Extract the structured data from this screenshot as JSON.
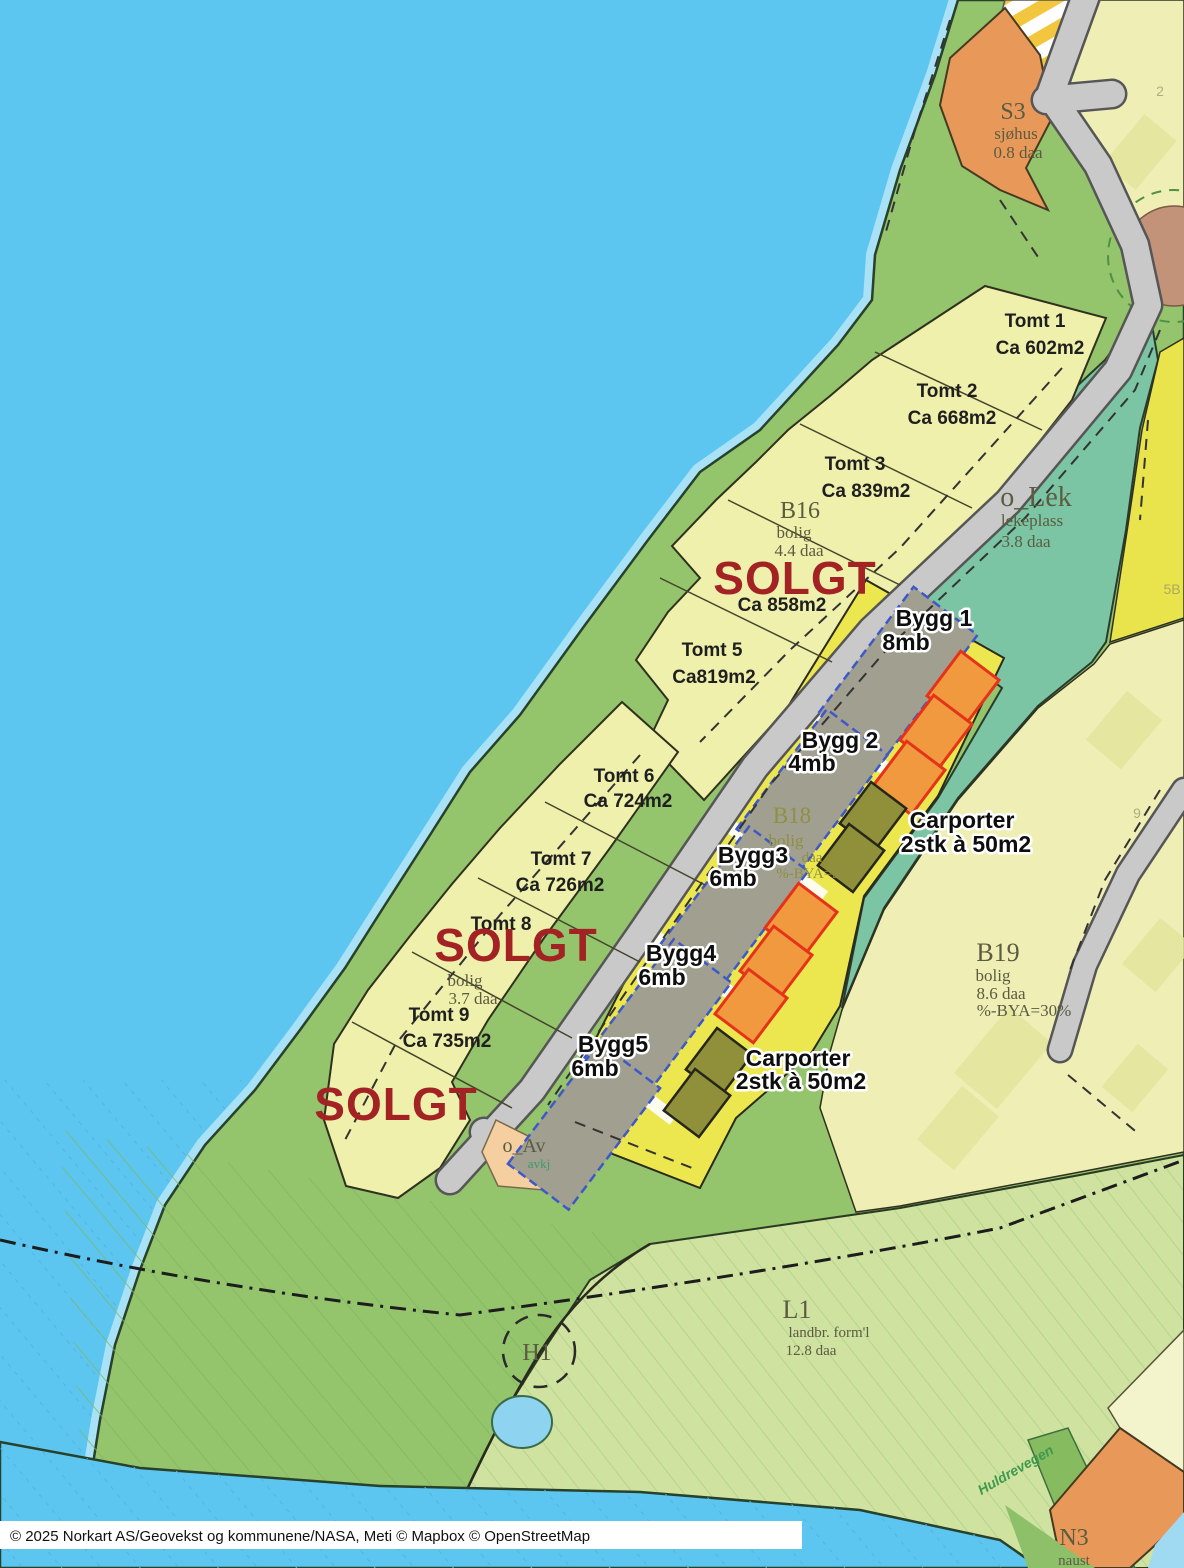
{
  "map": {
    "copyright": "© 2025 Norkart AS/Geovekst og kommunene/NASA, Meti © Mapbox © OpenStreetMap",
    "sold_label": "SOLGT",
    "street_name": "Huldrevegen",
    "areas": {
      "s3": {
        "code": "S3",
        "type": "sjøhus",
        "size": "0.8 daa"
      },
      "lek": {
        "code": "o_Lek",
        "type": "lekeplass",
        "size": "3.8 daa"
      },
      "b16": {
        "code": "B16",
        "type": "bolig",
        "size": "4.4 daa"
      },
      "b17": {
        "type": "bolig",
        "size": "3.7 daa"
      },
      "b18": {
        "code": "B18",
        "type": "bolig",
        "size": "daa",
        "bya": "%-BYA=30%"
      },
      "b19": {
        "code": "B19",
        "type": "bolig",
        "size": "8.6 daa",
        "bya": "%-BYA=30%"
      },
      "l1": {
        "code": "L1",
        "type": "landbr. form'l",
        "size": "12.8 daa"
      },
      "h1": {
        "code": "H1"
      },
      "n3": {
        "code": "N3",
        "type": "naust"
      },
      "av": {
        "code": "o_Av",
        "sub": "avkj"
      }
    },
    "plots": [
      {
        "name": "Tomt 1",
        "size": "Ca 602m2"
      },
      {
        "name": "Tomt 2",
        "size": "Ca 668m2"
      },
      {
        "name": "Tomt 3",
        "size": "Ca 839m2"
      },
      {
        "size": "Ca 858m2"
      },
      {
        "name": "Tomt 5",
        "size": "Ca819m2"
      },
      {
        "name": "Tomt 6",
        "size": "Ca 724m2"
      },
      {
        "name": "Tomt 7",
        "size": "Ca 726m2"
      },
      {
        "name": "Tomt 8"
      },
      {
        "name": "Tomt 9",
        "size": "Ca 735m2"
      }
    ],
    "buildings": [
      {
        "name": "Bygg 1",
        "height": "8mb"
      },
      {
        "name": "Bygg 2",
        "height": "4mb"
      },
      {
        "name": "Bygg3",
        "height": "6mb"
      },
      {
        "name": "Bygg4",
        "height": "6mb"
      },
      {
        "name": "Bygg5",
        "height": "6mb"
      }
    ],
    "carports": {
      "title": "Carporter",
      "detail": "2stk à 50m2"
    },
    "background_numbers": {
      "n2": "2",
      "n5b": "5B",
      "n9": "9"
    },
    "colors": {
      "sold_red": "#a32325",
      "water_blue": "#5cc6f0",
      "land_green": "#94c46c",
      "plot_yellow": "#eff0ab",
      "development_yellow": "#ece74e",
      "playground_teal": "#7cc5a4",
      "commercial_orange": "#e8995a",
      "carport_orange": "#f0993e",
      "carport_olive": "#90903a",
      "building_grey": "#a09f90"
    }
  }
}
